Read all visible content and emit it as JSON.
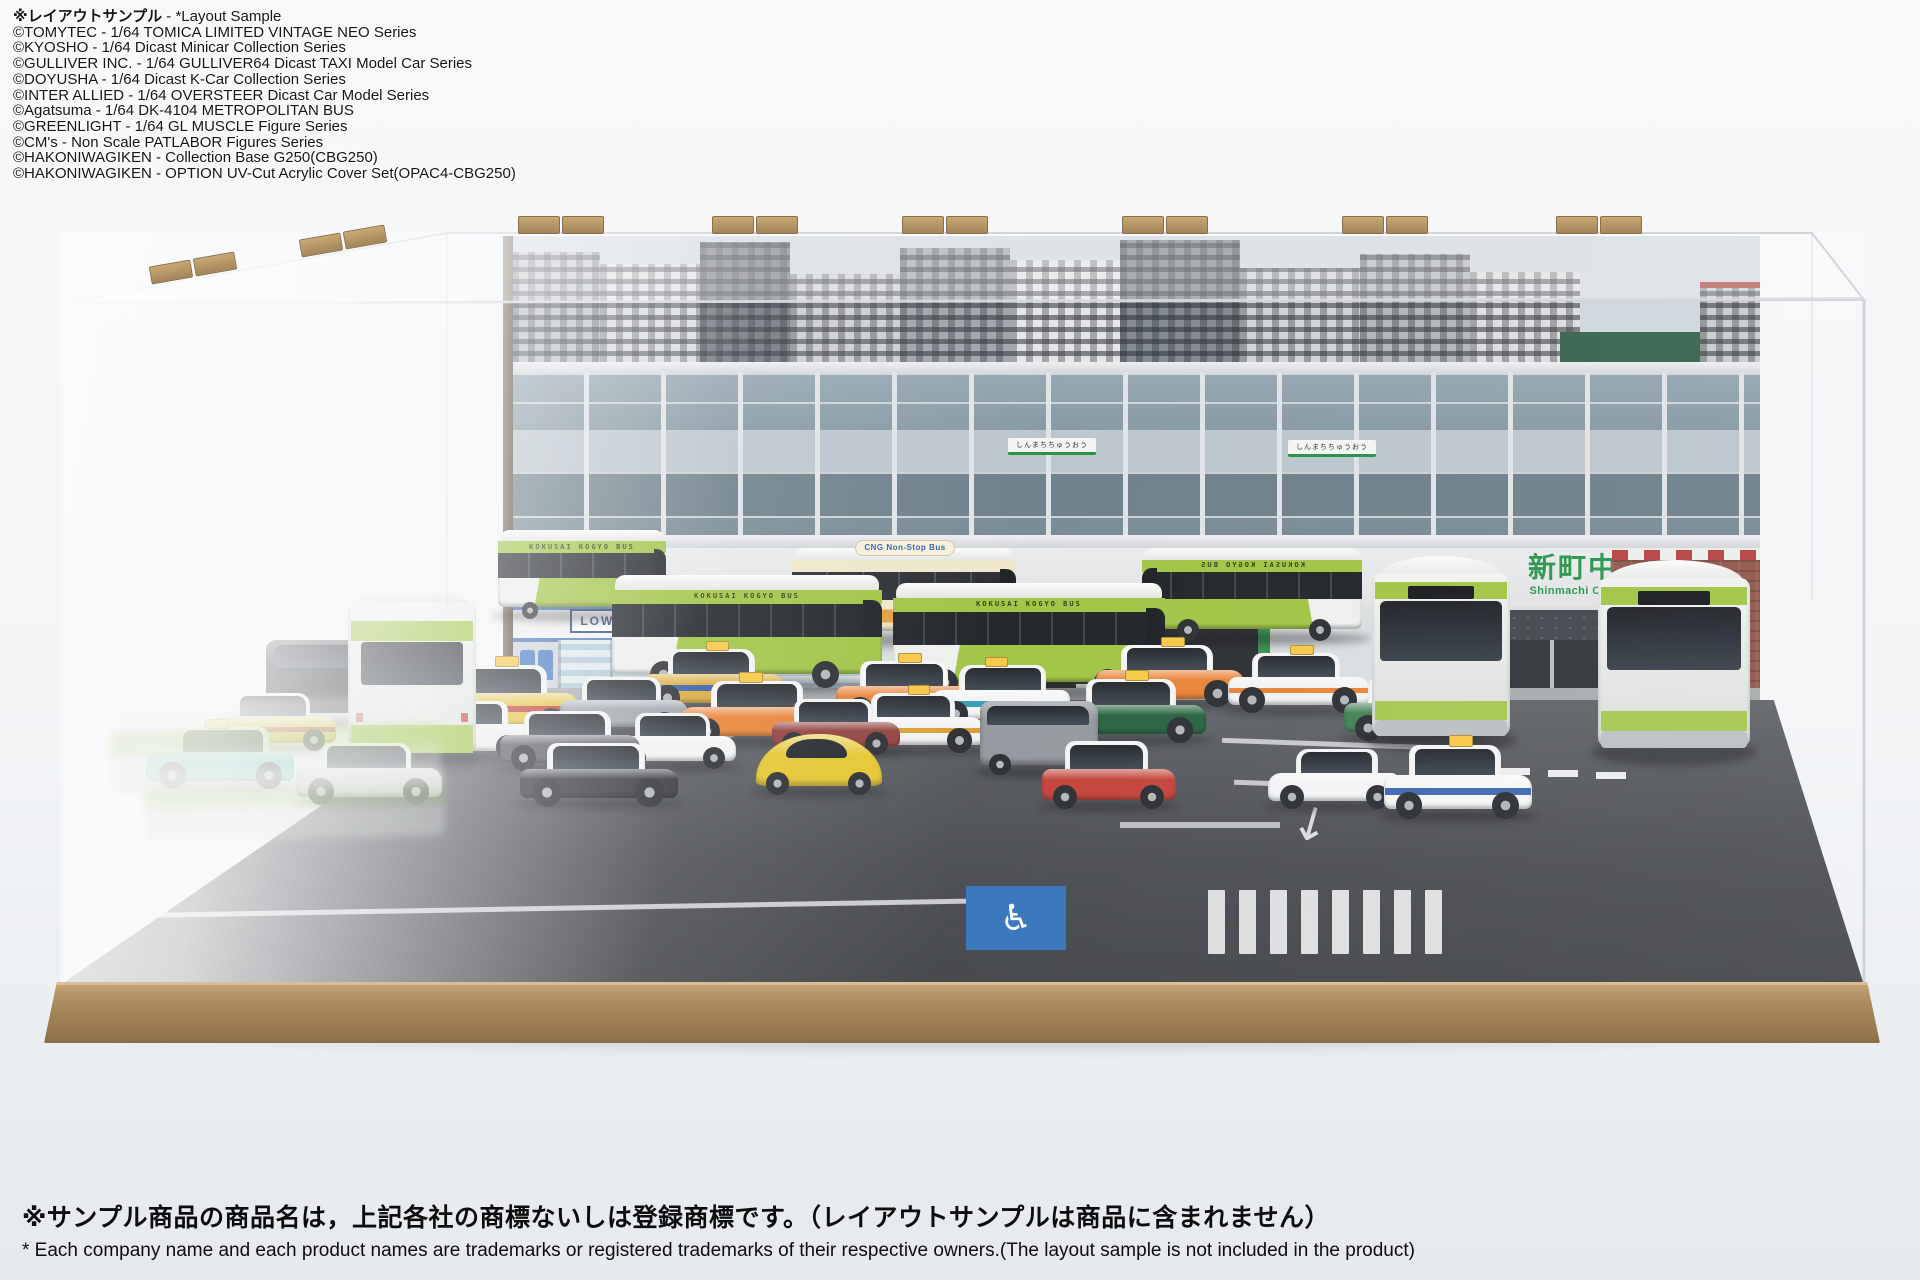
{
  "credits": {
    "heading_jp": "※レイアウトサンプル",
    "heading_en": " - *Layout Sample",
    "lines": [
      "©TOMYTEC - 1/64 TOMICA LIMITED VINTAGE NEO Series",
      "©KYOSHO - 1/64 Dicast Minicar Collection Series",
      "©GULLIVER INC. - 1/64 GULLIVER64 Dicast TAXI Model Car Series",
      "©DOYUSHA - 1/64 Dicast K-Car Collection Series",
      "©INTER ALLIED - 1/64 OVERSTEER Dicast Car Model Series",
      "©Agatsuma - 1/64 DK-4104 METROPOLITAN BUS",
      "©GREENLIGHT - 1/64 GL MUSCLE Figure Series",
      "©CM's - Non Scale PATLABOR Figures Series",
      "©HAKONIWAGIKEN - Collection Base G250(CBG250)",
      "©HAKONIWAGIKEN - OPTION UV-Cut Acrylic Cover Set(OPAC4-CBG250)"
    ]
  },
  "footer": {
    "jp": "※サンプル商品の商品名は，上記各社の商標ないしは登録商標です。（レイアウトサンプルは商品に含まれません）",
    "en": "* Each company name and each product names are trademarks or registered trademarks of their respective owners.(The layout sample is not included in the product)"
  },
  "backdrop": {
    "station_sign_jp": "新町中央駅",
    "station_sign_en": "Shinmachi Central Station",
    "platform_sign": "しんまちちゅうおう",
    "convenience_store": "LOWSUN"
  },
  "models": {
    "bus_side_text": "KOKUSAI KOGYO BUS",
    "cng_bus_text": "CNG Non-Stop Bus"
  },
  "colors": {
    "bus_green": "#9cc23c",
    "bus_white": "#f1f3f1",
    "cream_bus_body": "#efe6c6",
    "cream_bus_orange": "#e59a3a",
    "station_green": "#1f9145",
    "lowsun_blue": "#27427c",
    "base_wood": "#ab8c60",
    "asphalt": "#44474c",
    "handicap_blue": "#2f6fb8",
    "taxi_yellow": "#e2c039",
    "taxi_orange": "#e87e2f",
    "taxi_teal": "#53c3b1"
  },
  "scene": {
    "vehicles": [
      {
        "name": "kokusai-bus",
        "type": "bus",
        "x": 498,
        "y": 530,
        "w": 168,
        "h": 88,
        "body": "#9cc23c",
        "label": "bus"
      },
      {
        "name": "kokusai-bus",
        "type": "bus",
        "x": 612,
        "y": 575,
        "w": 270,
        "h": 112,
        "body": "#9cc23c",
        "label": "bus"
      },
      {
        "name": "kokusai-bus",
        "type": "bus",
        "x": 893,
        "y": 583,
        "w": 272,
        "h": 112,
        "body": "#9cc23c",
        "label": "bus"
      },
      {
        "name": "kokusai-bus",
        "type": "bus",
        "x": 1142,
        "y": 548,
        "w": 220,
        "h": 92,
        "body": "#9cc23c",
        "label": "bus",
        "flip": true
      },
      {
        "name": "cng-bus",
        "type": "bus",
        "x": 792,
        "y": 548,
        "w": 224,
        "h": 94,
        "body": "#efe6c6",
        "accent": "#e59a3a",
        "label": "cng",
        "cream": true
      },
      {
        "name": "kokusai-bus-rear",
        "type": "busrear",
        "x": 348,
        "y": 586,
        "w": 128,
        "h": 176,
        "body": "#9cc23c"
      },
      {
        "name": "kokusai-bus-front",
        "type": "busfront",
        "x": 1372,
        "y": 556,
        "w": 138,
        "h": 188,
        "body": "#9cc23c"
      },
      {
        "name": "kokusai-bus-front",
        "type": "busfront",
        "x": 1598,
        "y": 560,
        "w": 152,
        "h": 196,
        "body": "#9cc23c"
      },
      {
        "name": "taxi-yellow-red",
        "type": "car",
        "x": 214,
        "y": 692,
        "w": 122,
        "h": 58,
        "body": "#e2c039",
        "accent": "#c03a2e"
      },
      {
        "name": "taxi-teal",
        "type": "car",
        "x": 146,
        "y": 726,
        "w": 148,
        "h": 62,
        "body": "#53c3b1",
        "roof": "#e8f0ec",
        "sign": true,
        "flip": true
      },
      {
        "name": "black-minivan",
        "type": "minivan",
        "x": 266,
        "y": 636,
        "w": 128,
        "h": 88,
        "body": "#202327"
      },
      {
        "name": "silver-sedan",
        "type": "car",
        "x": 296,
        "y": 742,
        "w": 146,
        "h": 62,
        "body": "#c3c7cb"
      },
      {
        "name": "taxi-yellow-red",
        "type": "car",
        "x": 430,
        "y": 664,
        "w": 148,
        "h": 70,
        "body": "#e2c039",
        "accent": "#c03a2e",
        "sign": true
      },
      {
        "name": "white-sedan",
        "type": "car",
        "x": 398,
        "y": 700,
        "w": 132,
        "h": 58,
        "body": "#eceeef",
        "flip": true
      },
      {
        "name": "black-sedan",
        "type": "car",
        "x": 520,
        "y": 742,
        "w": 158,
        "h": 64,
        "body": "#2c2f34"
      },
      {
        "name": "gray-coupe",
        "type": "car",
        "x": 500,
        "y": 710,
        "w": 140,
        "h": 60,
        "body": "#51555b"
      },
      {
        "name": "silver-sedan",
        "type": "car",
        "x": 560,
        "y": 676,
        "w": 128,
        "h": 58,
        "body": "#9ba1a8"
      },
      {
        "name": "white-compact",
        "type": "car",
        "x": 614,
        "y": 712,
        "w": 122,
        "h": 56,
        "body": "#f2f3f3"
      },
      {
        "name": "taxi-yellow-blue",
        "type": "car",
        "x": 644,
        "y": 648,
        "w": 140,
        "h": 62,
        "body": "#d8a835",
        "accent": "#2e59a8",
        "sign": true
      },
      {
        "name": "taxi-orange",
        "type": "car",
        "x": 680,
        "y": 680,
        "w": 148,
        "h": 64,
        "body": "#e87e2f",
        "roof": "#f4f5f4",
        "sign": true,
        "flip": true
      },
      {
        "name": "beetle-yellow",
        "type": "beetle",
        "x": 756,
        "y": 730,
        "w": 126,
        "h": 64,
        "body": "#e3c428"
      },
      {
        "name": "maroon-sedan",
        "type": "car",
        "x": 772,
        "y": 698,
        "w": 128,
        "h": 56,
        "body": "#8d3a36"
      },
      {
        "name": "taxi-orange",
        "type": "car",
        "x": 836,
        "y": 660,
        "w": 142,
        "h": 62,
        "body": "#e87e2f",
        "roof": "#f4f5f4",
        "sign": true
      },
      {
        "name": "taxi-white-orange",
        "type": "car",
        "x": 848,
        "y": 692,
        "w": 136,
        "h": 60,
        "body": "#f0f1f1",
        "accent": "#d99a2e",
        "sign": true
      },
      {
        "name": "taxi-white-teal",
        "type": "car",
        "x": 930,
        "y": 664,
        "w": 140,
        "h": 62,
        "body": "#f1f2f3",
        "accent": "#2e9ab0",
        "sign": true,
        "flip": true
      },
      {
        "name": "silver-van",
        "type": "minivan",
        "x": 980,
        "y": 698,
        "w": 118,
        "h": 76,
        "body": "#8f949a"
      },
      {
        "name": "red-hatchback",
        "type": "car",
        "x": 1042,
        "y": 740,
        "w": 134,
        "h": 68,
        "body": "#c13b33"
      },
      {
        "name": "taxi-green",
        "type": "car",
        "x": 1062,
        "y": 678,
        "w": 144,
        "h": 64,
        "body": "#1f5c38",
        "roof": "#f2f3f2",
        "sign": true
      },
      {
        "name": "taxi-orange",
        "type": "car",
        "x": 1096,
        "y": 644,
        "w": 148,
        "h": 62,
        "body": "#e87e2f",
        "roof": "#f4f5f4",
        "sign": true
      },
      {
        "name": "taxi-white-orange",
        "type": "car",
        "x": 1228,
        "y": 652,
        "w": 142,
        "h": 60,
        "body": "#f0f1f2",
        "accent": "#e87e2f",
        "sign": true
      },
      {
        "name": "white-sedan",
        "type": "car",
        "x": 1268,
        "y": 748,
        "w": 132,
        "h": 60,
        "body": "#f2f3f4",
        "flip": true
      },
      {
        "name": "taxi-green-two-tone",
        "type": "car",
        "x": 1344,
        "y": 676,
        "w": 142,
        "h": 64,
        "body": "#3a7d4c",
        "roof": "#f1f2f1",
        "sign": true
      },
      {
        "name": "taxi-white-blue",
        "type": "car",
        "x": 1384,
        "y": 744,
        "w": 148,
        "h": 74,
        "body": "#f3f4f4",
        "accent": "#3a62b0",
        "sign": true
      }
    ]
  }
}
